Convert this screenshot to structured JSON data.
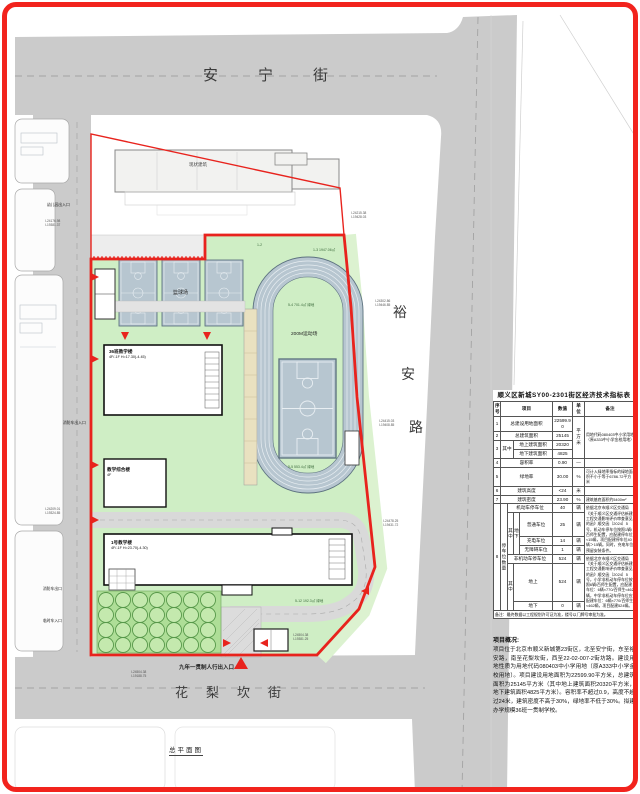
{
  "streets": {
    "north": "安宁街",
    "south": "花梨坎街",
    "east": [
      "裕",
      "安",
      "路"
    ]
  },
  "plan": {
    "title": "总平面图",
    "track_label": "200M运动场",
    "courts_label": "篮球场",
    "existing_building_label": "现状建筑",
    "entrances": {
      "main": "九年一贯制人行出入口",
      "kindergarten": "幼儿园出入口",
      "fire": "消防车出入口",
      "fire_exit": "消防车出口",
      "temp": "临时车入口"
    },
    "buildings": {
      "a1": "36班教学楼",
      "a2": "4F/-1F  H=17.30(-4.45)",
      "b1": "教学综合楼",
      "b2": "4F",
      "c1": "1号教学楼",
      "c2": "4F/-1F  H=23.70(-4.30)"
    },
    "green_tags": [
      "1-2",
      "1-3 1947.06㎡",
      "5-4 701.4㎡ 绿地",
      "5-5 553.4㎡ 绿地",
      "5-12 192.3㎡ 绿地"
    ],
    "coords": [
      "I-24176.98\nI-19381.37",
      "I-24209.01\nI-19324.85",
      "I-24215.38\nI-19428.03",
      "I-24302.86\nI-19446.85",
      "I-24415.03\nI-19408.85",
      "I-24478.25\nI-19431.72",
      "I-24504.38\nI-19381.25",
      "I-24504.38\nI-19188.75"
    ]
  },
  "table": {
    "title": "顺义区新城SY00-2301街区经济技术指标表",
    "h": {
      "no": "序号",
      "item": "项目",
      "value": "数值",
      "unit": "单位",
      "remark": "备注"
    },
    "unit_sqm": "平方米",
    "r1": {
      "no": "1",
      "item": "总建设用地面积",
      "value": "22599.90",
      "remark": "用地代码080403中小学用地（原A333中小学金校用地）"
    },
    "r2": {
      "no": "2",
      "item": "总建筑面积",
      "value": "25145"
    },
    "r3": {
      "no": "3",
      "group": "其中",
      "item_a": "地上建筑面积",
      "value_a": "20320",
      "item_b": "地下建筑面积",
      "value_b": "4825"
    },
    "r4": {
      "no": "4",
      "item": "容积率",
      "value": "0.90",
      "unit": "—"
    },
    "r5": {
      "no": "5",
      "item": "绿地率",
      "value": "30.00",
      "unit": "%",
      "remark": "可计入绿地率指标的绿地面积不小于等于6786.72平方米"
    },
    "r6": {
      "no": "6",
      "item": "建筑高度",
      "value": "<24",
      "unit": "米"
    },
    "r7": {
      "no": "7",
      "item": "建筑密度",
      "value": "23.90",
      "unit": "%",
      "remark": "建筑基底面积约5400m²"
    },
    "r8": {
      "no": "8",
      "side": "停车位数量",
      "group": "其中",
      "sub": "地下",
      "motor": {
        "item": "机动车停车位",
        "value": "40",
        "unit": "辆",
        "remark": "依据北京市顺义区交通局《关于顺义区交通评估新建工程交通影响评价审查意见的函》顺交函〔2024〕5号，机动车停车位按照1辆/百师生配置，应配建停车位≈15辆，项目配建停车位40辆＞15辆。同时，充电车位预留安装条件。"
      },
      "p1": {
        "item": "普通车位",
        "value": "25",
        "unit": "辆"
      },
      "p2": {
        "item": "充电车位",
        "value": "14",
        "unit": "辆"
      },
      "p3": {
        "item": "无障碍车位",
        "value": "1",
        "unit": "辆"
      },
      "nonmotor": {
        "item": "非机动车停车位",
        "value": "524",
        "unit": "辆",
        "remark": "依据北京市顺义区交通局《关于顺义区交通评估新建工程交通影响评价审查意见的函》顺交函〔2024〕5号，小学非机动车停车位按照6辆/百师生配置，应配建车位：6辆×770/百师生≈462辆，中学非机动车停车位应配建车位：6辆×770/百师生≈462辆，项目配建524辆。"
      },
      "group2": "其中",
      "g1": {
        "item": "地上",
        "value": "524",
        "unit": "辆"
      },
      "g2": {
        "item": "地下",
        "value": "0",
        "unit": "辆"
      }
    },
    "footnote": "备注：最终数据以工程规划许可证为准，楼号以门牌号审批为准。"
  },
  "notes": {
    "title": "项目概况:",
    "body": "项目位于北京市顺义新城第23街区，北至安宁街，东至裕安路，南至花梨坎街，西至22-02-007-2街坊路。建设用地性质为用地代码080403中小学用地（原A333中小学金校用地）。项目建设用地面积为22599.90平方米，总建筑面积为25145平方米（其中地上建筑面积20320平方米，地下建筑面积4825平方米）。容积率不超过0.9，高度不超过24米，建筑密度不高于30%，绿地率不低于30%。拟建办学规模36班一贯制学校。"
  }
}
